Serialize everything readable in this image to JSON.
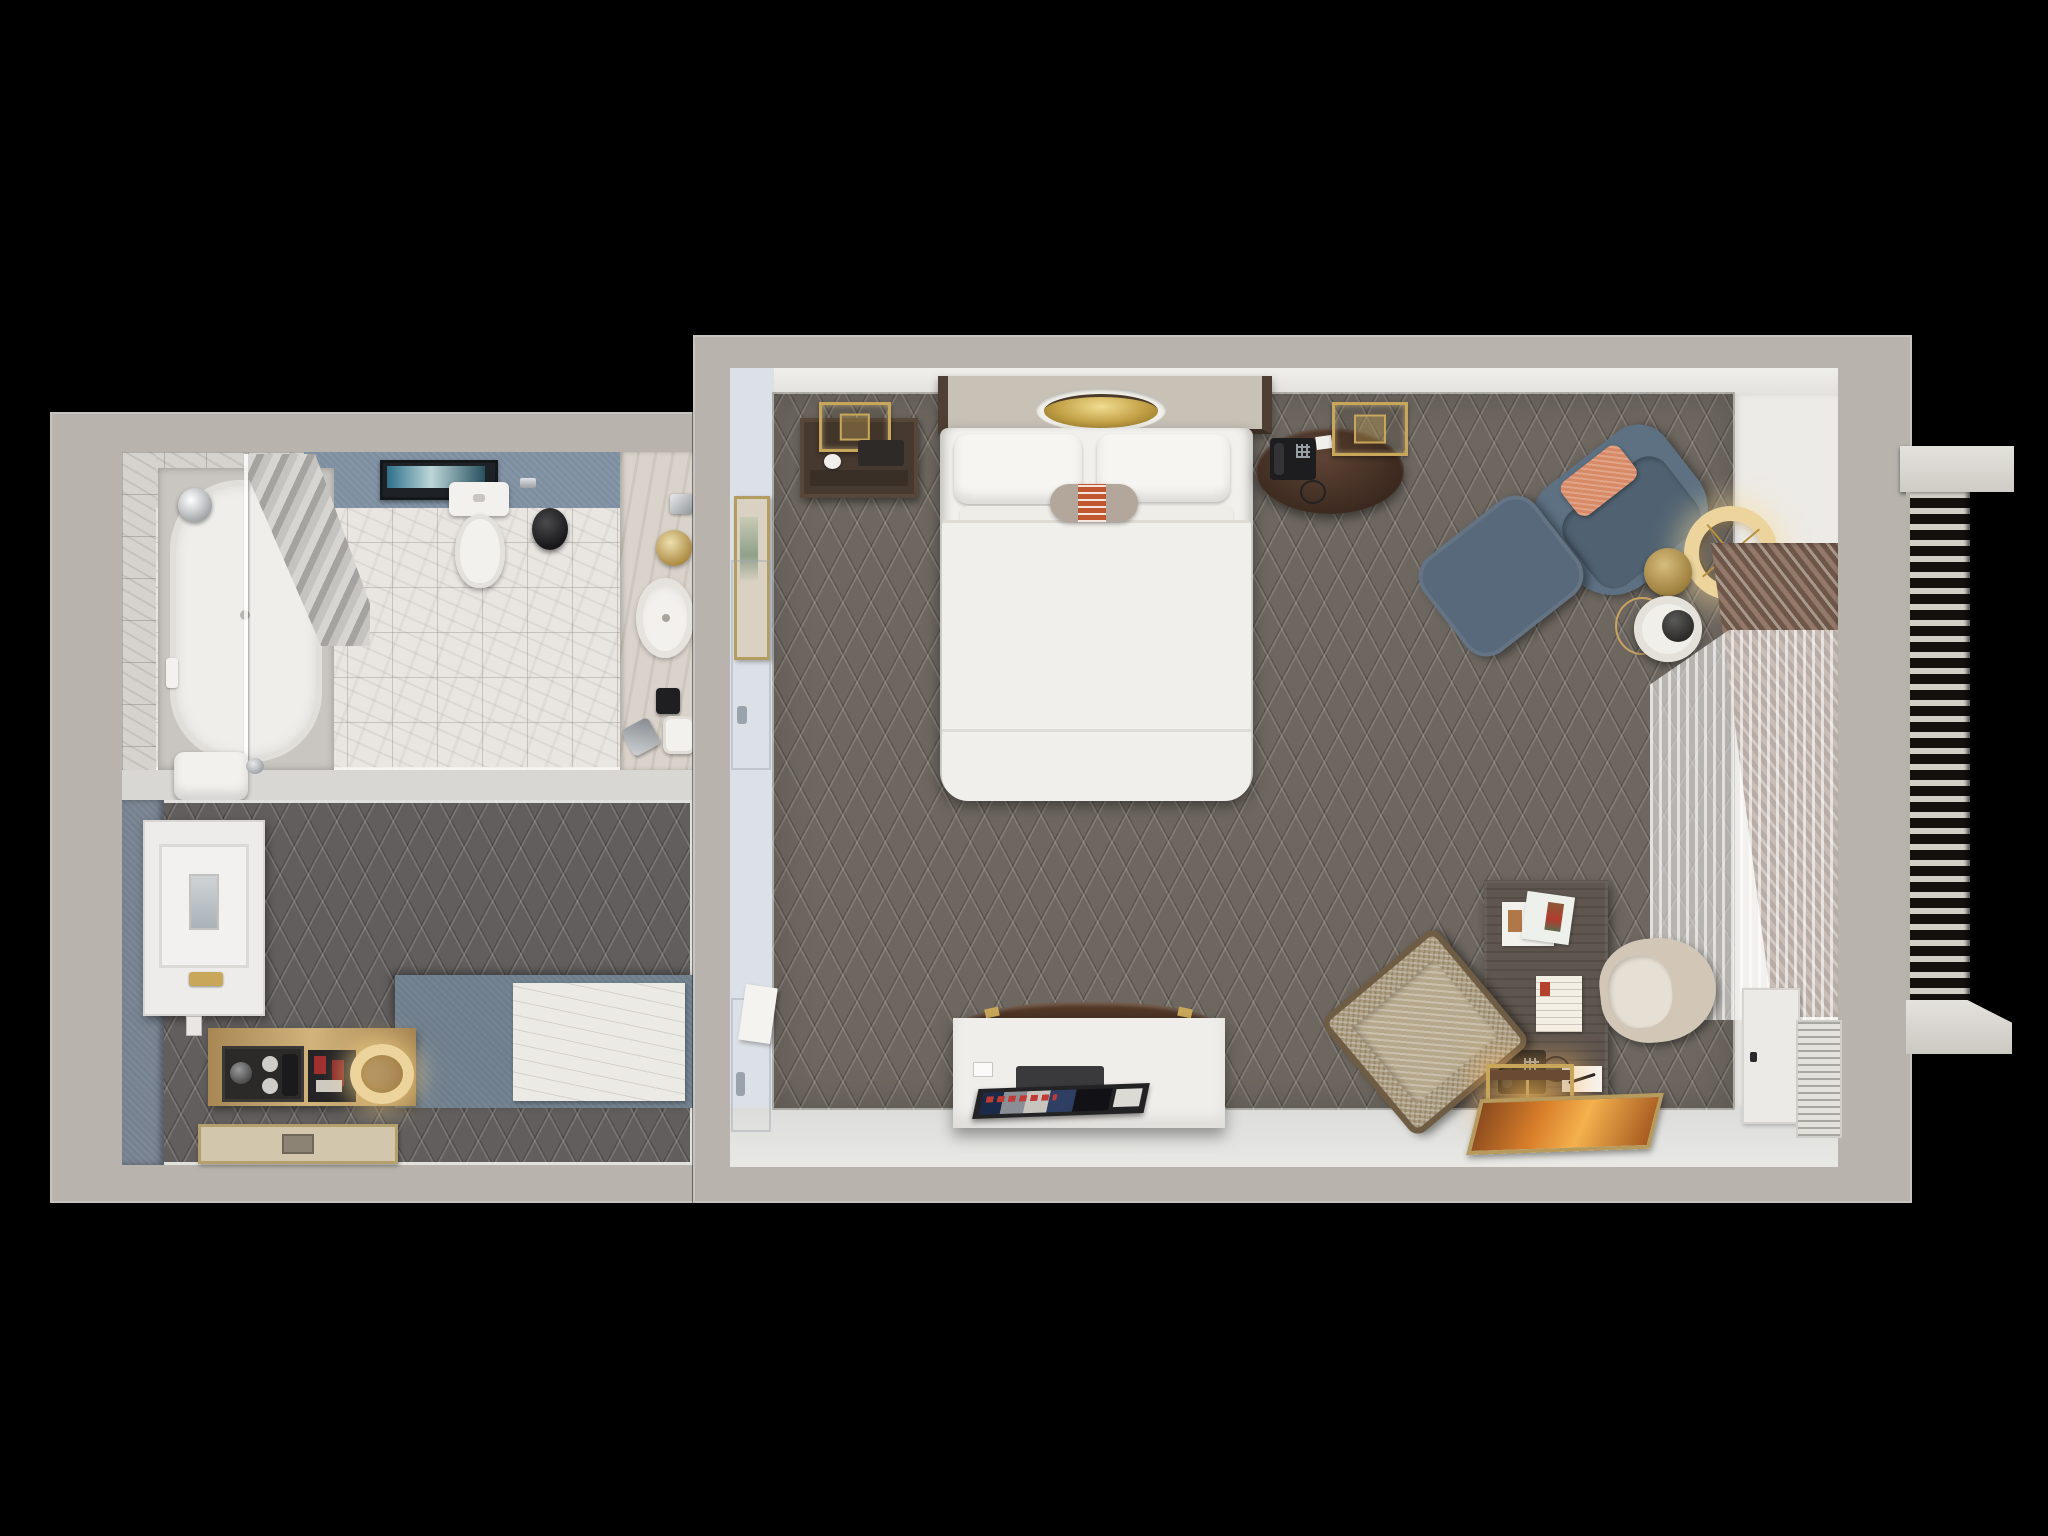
{
  "scene": {
    "kind": "3d-floorplan-top-down-render",
    "background": "#000000",
    "blocks": [
      "bathroom-entry-block",
      "bedroom-block",
      "exterior-window-radiator"
    ]
  },
  "palette": {
    "wall": "#b8b4ad",
    "divider": "#d9d7d3",
    "face-white": "#eae9e5",
    "face-blue": "#dce1e7",
    "face-bottom": "#dcdcda",
    "carpet": "#6d6760",
    "carpet-hi": "rgba(236,230,220,0.17)",
    "carpet-lo": "rgba(0,0,0,0.20)",
    "closet-carpet": "#615e5d",
    "blue-wall": "#76818f",
    "blue-band": "#7e8fa1",
    "marble": "#e9e6e2",
    "marble-wall": "#d6d3cf",
    "vanity": "#d9d3cb",
    "fixture-white": "#f3f1ed",
    "tub": "#efeeea",
    "wood-dark": "#44362c",
    "wood-mid": "#5f564f",
    "wood-tan": "#c2a065",
    "gold": "#c9a75a",
    "gold-light": "#ecd49c",
    "brass": "#b99c55",
    "blue-chair": "#5d7183",
    "blue-chair-seat": "#506272",
    "ottoman": "#57697a",
    "salmon-pillow": "#d88a66",
    "bolster-band": "#c0572e",
    "beige-chair": "#d2c6b7",
    "armchair": "#ab9c80",
    "blind-a": "#93796a",
    "blind-b": "#6e5649",
    "blind-c": "#a8988a",
    "sheer": "rgba(246,245,242,0.55)",
    "console-white": "#f0eeea",
    "screen-dark": "#232325",
    "art-orange": "#d97f2a",
    "mat": "#d2c6ad",
    "grille-light": "#d2cfc7",
    "grille-dark": "#14100d"
  },
  "bathroom": {
    "floor": "white-marble-tile",
    "items": [
      "bathtub",
      "glass-shower-screen",
      "shower-curtain",
      "shower-head",
      "wall-art-frame",
      "toilet",
      "toilet-paper-holder",
      "waste-bin",
      "vanity-counter",
      "vanity-sink",
      "vanity-faucet",
      "gold-decor-ball",
      "toiletries",
      "towel-roll",
      "grooming-set",
      "towel-stack"
    ]
  },
  "entry_closet": {
    "floor": "dark-diamond-carpet",
    "items": [
      "ironing-board-cabinet",
      "wall-outlet",
      "luggage-counter",
      "counter-sheet",
      "minibar-cabinet",
      "safe",
      "minibar-bottles",
      "ring-lamp",
      "floor-mat"
    ]
  },
  "bedroom": {
    "floor": "dark-diamond-carpet",
    "items": [
      "headboard-canopy",
      "gold-dome-pendant",
      "bed",
      "pillows",
      "bolster-pillow",
      "duvet",
      "nightstand",
      "nightstand-lamp",
      "coffee-cup",
      "round-phone-table",
      "telephone",
      "table-lamp",
      "lounge-chair",
      "accent-pillow",
      "ottoman",
      "ring-floor-lamp",
      "brass-side-table",
      "wire-side-table",
      "white-side-table",
      "wall-artwork",
      "bathroom-door",
      "entry-door",
      "tv-console",
      "tv-screen",
      "desk",
      "magazines",
      "letter-card",
      "desk-telephone",
      "notepad-pen",
      "desk-chair",
      "armchair",
      "luggage-rack",
      "leaning-floor-art",
      "ptac-cabinet",
      "vent-cabinet",
      "wood-slat-blind",
      "sheer-curtain"
    ]
  },
  "exterior": {
    "items": [
      "window-sill-top",
      "radiator-grille",
      "window-sill-bottom"
    ]
  }
}
